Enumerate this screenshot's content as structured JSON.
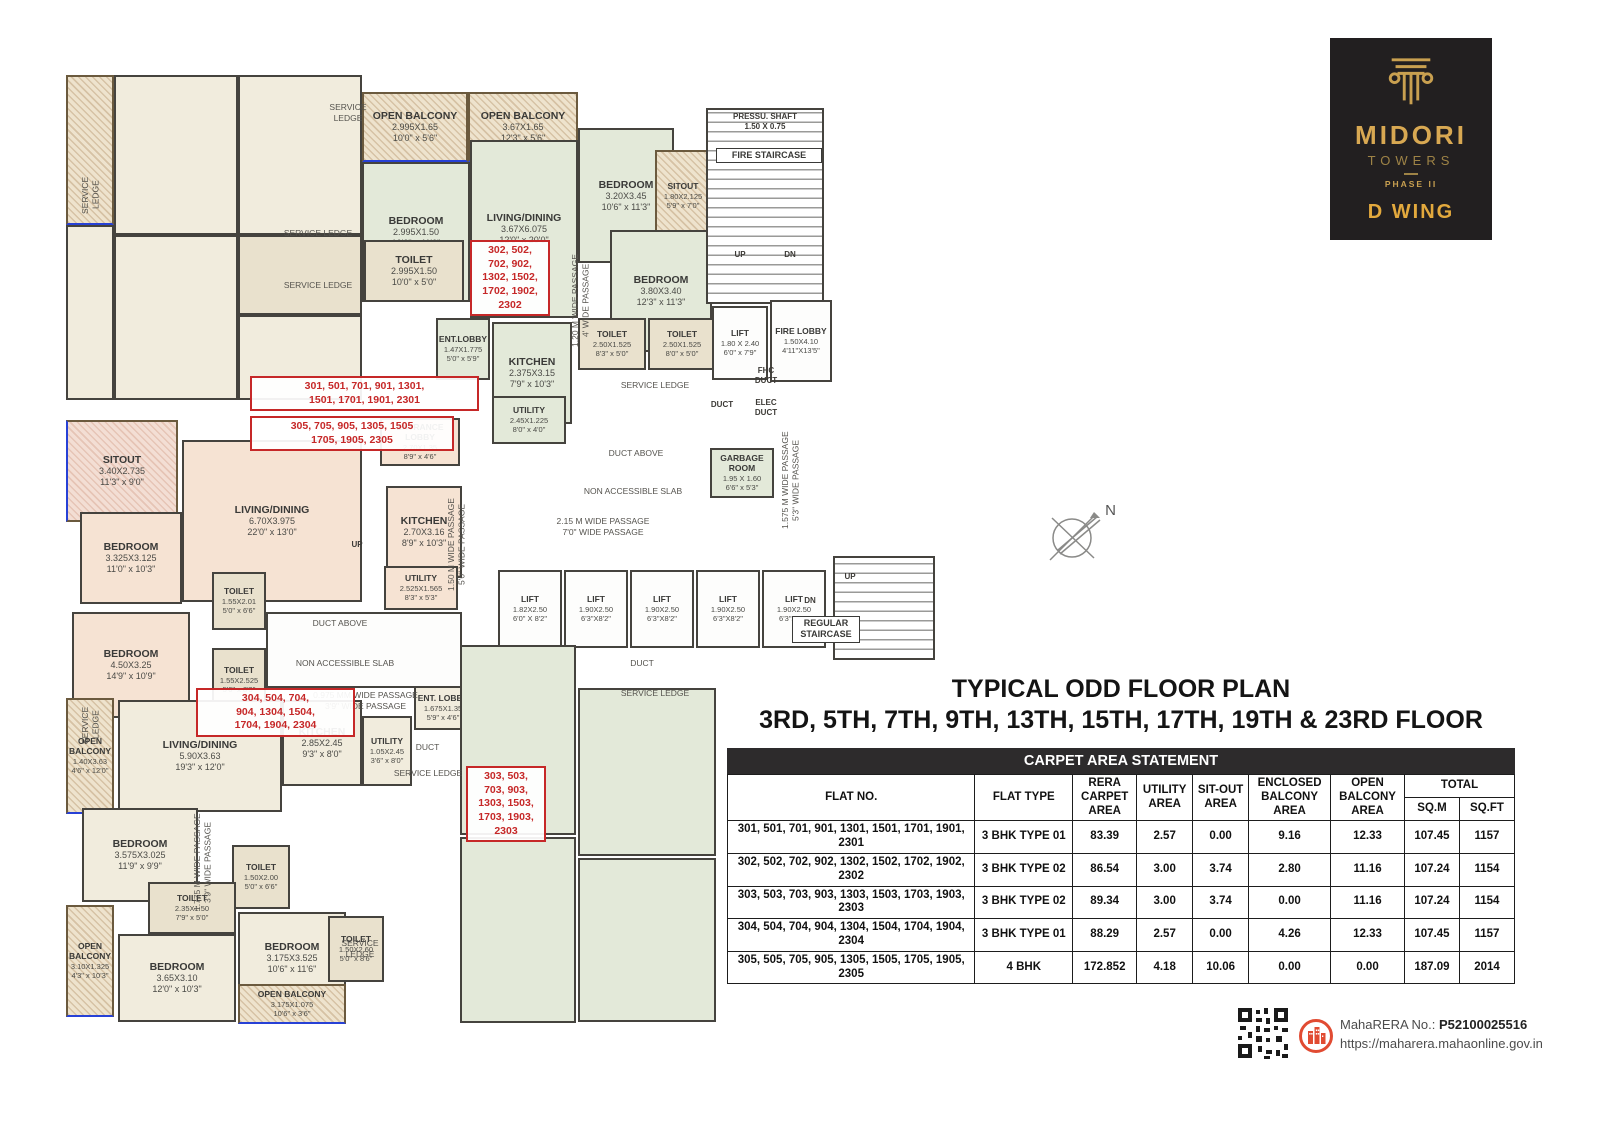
{
  "logo": {
    "brand": "MIDORI",
    "sub": "TOWERS",
    "phase": "PHASE II",
    "wing": "D WING"
  },
  "title": {
    "line1": "TYPICAL ODD FLOOR PLAN",
    "line2": "3RD, 5TH, 7TH, 9TH, 13TH, 15TH, 17TH, 19TH & 23RD FLOOR"
  },
  "compass": {
    "label": "N"
  },
  "footer": {
    "rera_label": "MahaRERA No.:",
    "rera_value": "P52100025516",
    "url": "https://maharera.mahaonline.gov.in"
  },
  "table": {
    "title": "CARPET AREA STATEMENT",
    "headers": {
      "flat_no": "FLAT NO.",
      "flat_type": "FLAT TYPE",
      "rera": "RERA CARPET AREA",
      "utility": "UTILITY AREA",
      "sitout": "SIT-OUT AREA",
      "enclosed": "ENCLOSED BALCONY AREA",
      "open": "OPEN BALCONY AREA",
      "total": "TOTAL",
      "sqm": "SQ.M",
      "sqft": "SQ.FT"
    },
    "rows": [
      [
        "301, 501, 701, 901, 1301, 1501, 1701, 1901, 2301",
        "3 BHK TYPE 01",
        "83.39",
        "2.57",
        "0.00",
        "9.16",
        "12.33",
        "107.45",
        "1157"
      ],
      [
        "302, 502, 702, 902, 1302, 1502, 1702, 1902, 2302",
        "3 BHK TYPE 02",
        "86.54",
        "3.00",
        "3.74",
        "2.80",
        "11.16",
        "107.24",
        "1154"
      ],
      [
        "303, 503, 703, 903, 1303, 1503, 1703, 1903, 2303",
        "3 BHK TYPE 02",
        "89.34",
        "3.00",
        "3.74",
        "0.00",
        "11.16",
        "107.24",
        "1154"
      ],
      [
        "304, 504, 704, 904, 1304, 1504, 1704, 1904, 2304",
        "3 BHK TYPE 01",
        "88.29",
        "2.57",
        "0.00",
        "4.26",
        "12.33",
        "107.45",
        "1157"
      ],
      [
        "305, 505, 705, 905, 1305, 1505, 1705, 1905, 2305",
        "4 BHK",
        "172.852",
        "4.18",
        "10.06",
        "0.00",
        "0.00",
        "187.09",
        "2014"
      ]
    ]
  },
  "floorplan": {
    "rooms": [
      {
        "x": 66,
        "y": 75,
        "w": 48,
        "h": 150,
        "c": "bal"
      },
      {
        "x": 114,
        "y": 75,
        "w": 124,
        "h": 160,
        "c": "crm"
      },
      {
        "x": 238,
        "y": 75,
        "w": 124,
        "h": 160,
        "c": "crm"
      },
      {
        "x": 114,
        "y": 235,
        "w": 124,
        "h": 165,
        "c": "crm"
      },
      {
        "x": 238,
        "y": 235,
        "w": 124,
        "h": 80,
        "c": "toi"
      },
      {
        "x": 66,
        "y": 225,
        "w": 48,
        "h": 175,
        "c": "crm"
      },
      {
        "x": 238,
        "y": 315,
        "w": 124,
        "h": 85,
        "c": "crm"
      },
      {
        "n": "OPEN BALCONY",
        "m": "2.995X1.65",
        "f": "10'0\" x 5'6\"",
        "x": 362,
        "y": 92,
        "w": 106,
        "h": 70,
        "c": "bal"
      },
      {
        "n": "OPEN BALCONY",
        "m": "3.67X1.65",
        "f": "12'3\" x 5'6\"",
        "x": 468,
        "y": 92,
        "w": 110,
        "h": 70,
        "c": "bal"
      },
      {
        "n": "BEDROOM",
        "m": "2.995X1.50",
        "f": "10'0\" x 11'0\"",
        "x": 362,
        "y": 162,
        "w": 108,
        "h": 140,
        "c": "grn"
      },
      {
        "n": "LIVING/DINING",
        "m": "3.67X6.075",
        "f": "12'0\" x 20'0\"",
        "x": 470,
        "y": 140,
        "w": 108,
        "h": 178,
        "c": "grn"
      },
      {
        "n": "BEDROOM",
        "m": "3.20X3.45",
        "f": "10'6\" x 11'3\"",
        "x": 578,
        "y": 128,
        "w": 96,
        "h": 135,
        "c": "grn"
      },
      {
        "n": "SITOUT",
        "m": "1.80X2.125",
        "f": "5'9\" x 7'0\"",
        "x": 655,
        "y": 150,
        "w": 56,
        "h": 92,
        "c": "bal"
      },
      {
        "n": "BEDROOM",
        "m": "3.80X3.40",
        "f": "12'3\" x 11'3\"",
        "x": 610,
        "y": 230,
        "w": 102,
        "h": 122,
        "c": "grn"
      },
      {
        "n": "TOILET",
        "m": "2.995X1.50",
        "f": "10'0\" x 5'0\"",
        "x": 364,
        "y": 240,
        "w": 100,
        "h": 62,
        "c": "toi"
      },
      {
        "n": "TOILET",
        "m": "2.50X1.525",
        "f": "8'3\" x 5'0\"",
        "x": 578,
        "y": 318,
        "w": 68,
        "h": 52,
        "c": "toi"
      },
      {
        "n": "TOILET",
        "m": "2.50X1.525",
        "f": "8'0\" x 5'0\"",
        "x": 648,
        "y": 318,
        "w": 68,
        "h": 52,
        "c": "toi"
      },
      {
        "n": "KITCHEN",
        "m": "2.375X3.15",
        "f": "7'9\" x 10'3\"",
        "x": 492,
        "y": 322,
        "w": 80,
        "h": 102,
        "c": "grn"
      },
      {
        "n": "ENT.LOBBY",
        "m": "1.47X1.775",
        "f": "5'0\" x 5'9\"",
        "x": 436,
        "y": 318,
        "w": 54,
        "h": 62,
        "c": "grn"
      },
      {
        "n": "UTILITY",
        "m": "2.45X1.225",
        "f": "8'0\" x 4'0\"",
        "x": 492,
        "y": 396,
        "w": 74,
        "h": 48,
        "c": "grn"
      },
      {
        "x": 706,
        "y": 108,
        "w": 118,
        "h": 196,
        "c": "stair"
      },
      {
        "n": "LIFT",
        "m": "1.80 X 2.40",
        "f": "6'0\" x 7'9\"",
        "x": 712,
        "y": 306,
        "w": 56,
        "h": 74,
        "c": "wht"
      },
      {
        "n": "FIRE LOBBY",
        "m": "1.50X4.10",
        "f": "4'11\"X13'5\"",
        "x": 770,
        "y": 300,
        "w": 62,
        "h": 82,
        "c": "wht"
      },
      {
        "n": "GARBAGE ROOM",
        "m": "1.95 X 1.60",
        "f": "6'6\" x 5'3\"",
        "x": 710,
        "y": 448,
        "w": 64,
        "h": 50,
        "c": "grn"
      },
      {
        "n": "SITOUT",
        "m": "3.40X2.735",
        "f": "11'3\" x 9'0\"",
        "x": 66,
        "y": 420,
        "w": 112,
        "h": 102,
        "c": "balp"
      },
      {
        "n": "BEDROOM",
        "m": "3.325X3.125",
        "f": "11'0\" x 10'3\"",
        "x": 80,
        "y": 512,
        "w": 102,
        "h": 92,
        "c": "pch"
      },
      {
        "n": "BEDROOM",
        "m": "4.50X3.25",
        "f": "14'9\" x 10'9\"",
        "x": 72,
        "y": 612,
        "w": 118,
        "h": 106,
        "c": "pch"
      },
      {
        "n": "LIVING/DINING",
        "m": "6.70X3.975",
        "f": "22'0\" x 13'0\"",
        "x": 182,
        "y": 440,
        "w": 180,
        "h": 162,
        "c": "pch"
      },
      {
        "n": "ENTRANCE LOBBY",
        "m": "2.70X1.35",
        "f": "8'9\" x 4'6\"",
        "x": 380,
        "y": 418,
        "w": 80,
        "h": 48,
        "c": "pch"
      },
      {
        "n": "KITCHEN",
        "m": "2.70X3.16",
        "f": "8'9\" x 10'3\"",
        "x": 386,
        "y": 486,
        "w": 76,
        "h": 92,
        "c": "pch"
      },
      {
        "n": "UTILITY",
        "m": "2.525X1.565",
        "f": "8'3\" x 5'3\"",
        "x": 384,
        "y": 566,
        "w": 74,
        "h": 44,
        "c": "pch"
      },
      {
        "n": "TOILET",
        "m": "1.55X2.01",
        "f": "5'0\" x 6'6\"",
        "x": 212,
        "y": 572,
        "w": 54,
        "h": 58,
        "c": "toi"
      },
      {
        "n": "TOILET",
        "m": "1.55X2.525",
        "f": "5'0\" x 8'3\"",
        "x": 212,
        "y": 648,
        "w": 54,
        "h": 64,
        "c": "toi"
      },
      {
        "x": 266,
        "y": 612,
        "w": 196,
        "h": 76,
        "c": "wht"
      },
      {
        "n": "LIFT",
        "m": "1.82X2.50",
        "f": "6'0\" X 8'2\"",
        "x": 498,
        "y": 570,
        "w": 64,
        "h": 78,
        "c": "wht"
      },
      {
        "n": "LIFT",
        "m": "1.90X2.50",
        "f": "6'3\"X8'2\"",
        "x": 564,
        "y": 570,
        "w": 64,
        "h": 78,
        "c": "wht"
      },
      {
        "n": "LIFT",
        "m": "1.90X2.50",
        "f": "6'3\"X8'2\"",
        "x": 630,
        "y": 570,
        "w": 64,
        "h": 78,
        "c": "wht"
      },
      {
        "n": "LIFT",
        "m": "1.90X2.50",
        "f": "6'3\"X8'2\"",
        "x": 696,
        "y": 570,
        "w": 64,
        "h": 78,
        "c": "wht"
      },
      {
        "n": "LIFT",
        "m": "1.90X2.50",
        "f": "6'3\"X8'2\"",
        "x": 762,
        "y": 570,
        "w": 64,
        "h": 78,
        "c": "wht"
      },
      {
        "x": 833,
        "y": 556,
        "w": 102,
        "h": 104,
        "c": "stair"
      },
      {
        "n": "OPEN BALCONY",
        "m": "1.40X3.63",
        "f": "4'6\" x 12'0\"",
        "x": 66,
        "y": 698,
        "w": 48,
        "h": 116,
        "c": "bal"
      },
      {
        "n": "LIVING/DINING",
        "m": "5.90X3.63",
        "f": "19'3\" x 12'0\"",
        "x": 118,
        "y": 700,
        "w": 164,
        "h": 112,
        "c": "crm"
      },
      {
        "n": "KITCHEN",
        "m": "2.85X2.45",
        "f": "9'3\" x 8'0\"",
        "x": 282,
        "y": 700,
        "w": 80,
        "h": 86,
        "c": "crm"
      },
      {
        "n": "UTILITY",
        "m": "1.05X2.45",
        "f": "3'6\" x 8'0\"",
        "x": 362,
        "y": 716,
        "w": 50,
        "h": 70,
        "c": "crm"
      },
      {
        "n": "ENT. LOBBY",
        "m": "1.675X1.35",
        "f": "5'9\" x 4'6\"",
        "x": 414,
        "y": 686,
        "w": 58,
        "h": 44,
        "c": "crm"
      },
      {
        "n": "BEDROOM",
        "m": "3.575X3.025",
        "f": "11'9\" x 9'9\"",
        "x": 82,
        "y": 808,
        "w": 116,
        "h": 94,
        "c": "crm"
      },
      {
        "n": "TOILET",
        "m": "1.50X2.00",
        "f": "5'0\" x 6'6\"",
        "x": 232,
        "y": 845,
        "w": 58,
        "h": 64,
        "c": "toi"
      },
      {
        "n": "TOILET",
        "m": "2.35X1.50",
        "f": "7'9\" x 5'0\"",
        "x": 148,
        "y": 882,
        "w": 88,
        "h": 52,
        "c": "toi"
      },
      {
        "n": "BEDROOM",
        "m": "3.65X3.10",
        "f": "12'0\" x 10'3\"",
        "x": 118,
        "y": 934,
        "w": 118,
        "h": 88,
        "c": "crm"
      },
      {
        "n": "BEDROOM",
        "m": "3.175X3.525",
        "f": "10'6\" x 11'6\"",
        "x": 238,
        "y": 912,
        "w": 108,
        "h": 92,
        "c": "crm"
      },
      {
        "n": "TOILET",
        "m": "1.50X2.60",
        "f": "5'0\" x 8'6\"",
        "x": 328,
        "y": 916,
        "w": 56,
        "h": 66,
        "c": "toi"
      },
      {
        "n": "OPEN BALCONY",
        "m": "3.175X1.075",
        "f": "10'6\" x 3'6\"",
        "x": 238,
        "y": 984,
        "w": 108,
        "h": 40,
        "c": "bal"
      },
      {
        "n": "OPEN BALCONY",
        "m": "3.10X1.325",
        "f": "4'3\" x 10'3\"",
        "x": 66,
        "y": 905,
        "w": 48,
        "h": 112,
        "c": "bal"
      },
      {
        "x": 460,
        "y": 645,
        "w": 116,
        "h": 190,
        "c": "grn"
      },
      {
        "x": 578,
        "y": 688,
        "w": 138,
        "h": 168,
        "c": "grn"
      },
      {
        "x": 578,
        "y": 858,
        "w": 138,
        "h": 164,
        "c": "grn"
      },
      {
        "x": 460,
        "y": 837,
        "w": 116,
        "h": 186,
        "c": "grn"
      }
    ],
    "flat_labels": [
      {
        "t": "302, 502,\n702, 902,\n1302, 1502,\n1702, 1902,\n2302",
        "x": 470,
        "y": 240,
        "w": 66
      },
      {
        "t": "301, 501, 701, 901, 1301,\n1501, 1701, 1901, 2301",
        "x": 250,
        "y": 376,
        "w": 215
      },
      {
        "t": "305, 705, 905, 1305, 1505\n1705, 1905, 2305",
        "x": 250,
        "y": 416,
        "w": 190
      },
      {
        "t": "304, 504, 704,\n904, 1304, 1504,\n1704, 1904, 2304",
        "x": 196,
        "y": 688,
        "w": 145
      },
      {
        "t": "303, 503,\n703, 903,\n1303, 1503,\n1703, 1903,\n2303",
        "x": 466,
        "y": 766,
        "w": 66
      }
    ],
    "texts": [
      {
        "t": "PRESSU. SHAFT\n1.50 X 0.75",
        "x": 712,
        "y": 112,
        "w": 106,
        "c": "tiny"
      },
      {
        "t": "FIRE STAIRCASE",
        "x": 716,
        "y": 148,
        "w": 98,
        "c": "boxed"
      },
      {
        "t": "UP",
        "x": 728,
        "y": 250,
        "w": 24,
        "c": "tiny"
      },
      {
        "t": "DN",
        "x": 778,
        "y": 250,
        "w": 24,
        "c": "tiny"
      },
      {
        "t": "FHC\nDUCT",
        "x": 746,
        "y": 366,
        "w": 40,
        "c": "tiny"
      },
      {
        "t": "DUCT",
        "x": 702,
        "y": 400,
        "w": 40,
        "c": "tiny"
      },
      {
        "t": "ELEC\nDUCT",
        "x": 746,
        "y": 398,
        "w": 40,
        "c": "tiny"
      },
      {
        "t": "SERVICE LEDGE",
        "x": 600,
        "y": 380,
        "w": 110,
        "c": "sl"
      },
      {
        "t": "DUCT ABOVE",
        "x": 588,
        "y": 448,
        "w": 96,
        "c": "sl"
      },
      {
        "t": "NON ACCESSIBLE SLAB",
        "x": 558,
        "y": 486,
        "w": 150,
        "c": "sl"
      },
      {
        "t": "SERVICE LEDGE",
        "x": 268,
        "y": 228,
        "w": 100,
        "c": "sl"
      },
      {
        "t": "SERVICE LEDGE",
        "x": 268,
        "y": 280,
        "w": 100,
        "c": "sl"
      },
      {
        "t": "SERVICE\nLEDGE",
        "x": 318,
        "y": 102,
        "w": 60,
        "c": "sl"
      },
      {
        "t": "DUCT ABOVE",
        "x": 292,
        "y": 618,
        "w": 96,
        "c": "sl"
      },
      {
        "t": "NON ACCESSIBLE SLAB",
        "x": 270,
        "y": 658,
        "w": 150,
        "c": "sl"
      },
      {
        "t": "UP",
        "x": 345,
        "y": 540,
        "w": 24,
        "c": "tiny"
      },
      {
        "t": "2.15 M WIDE PASSAGE\n7'0\" WIDE PASSAGE",
        "x": 528,
        "y": 516,
        "w": 150,
        "c": "sl"
      },
      {
        "t": "UP",
        "x": 838,
        "y": 572,
        "w": 24,
        "c": "tiny"
      },
      {
        "t": "DN",
        "x": 798,
        "y": 596,
        "w": 24,
        "c": "tiny"
      },
      {
        "t": "REGULAR\nSTAIRCASE",
        "x": 792,
        "y": 616,
        "w": 60,
        "c": "boxed"
      },
      {
        "t": "DUCT",
        "x": 612,
        "y": 658,
        "w": 60,
        "c": "sl"
      },
      {
        "t": "SERVICE LEDGE",
        "x": 600,
        "y": 688,
        "w": 110,
        "c": "sl"
      },
      {
        "t": "0.975 MM WIDE PASSAGE\n3'9\" WIDE PASSAGE",
        "x": 288,
        "y": 690,
        "w": 155,
        "c": "sl"
      },
      {
        "t": "DUCT",
        "x": 400,
        "y": 742,
        "w": 55,
        "c": "sl"
      },
      {
        "t": "SERVICE LEDGE",
        "x": 388,
        "y": 768,
        "w": 80,
        "c": "sl"
      },
      {
        "t": "SERVICE\nLEDGE",
        "x": 330,
        "y": 938,
        "w": 60,
        "c": "sl"
      },
      {
        "t": "1.20 M WIDE PASSAGE\n4' WIDE PASSAGE",
        "x": 570,
        "y": 238,
        "h": 125,
        "r": 1
      },
      {
        "t": "1.50 M WIDE PASSAGE\n5'0\" WIDE PASSAGE",
        "x": 446,
        "y": 482,
        "h": 125,
        "r": 1
      },
      {
        "t": "1.575 M WIDE PASSAGE\n5'3\" WIDE PASSAGE",
        "x": 780,
        "y": 418,
        "h": 125,
        "r": 1
      },
      {
        "t": "1.775 M WIDE PASSAGE\n3'9\" WIDE PASSAGE",
        "x": 192,
        "y": 800,
        "h": 125,
        "r": 1
      },
      {
        "t": "SERVICE\nLEDGE",
        "x": 80,
        "y": 160,
        "h": 70,
        "r": 1,
        "c": "sl"
      },
      {
        "t": "SERVICE\nLEDGE",
        "x": 80,
        "y": 690,
        "h": 70,
        "r": 1,
        "c": "sl"
      }
    ]
  }
}
